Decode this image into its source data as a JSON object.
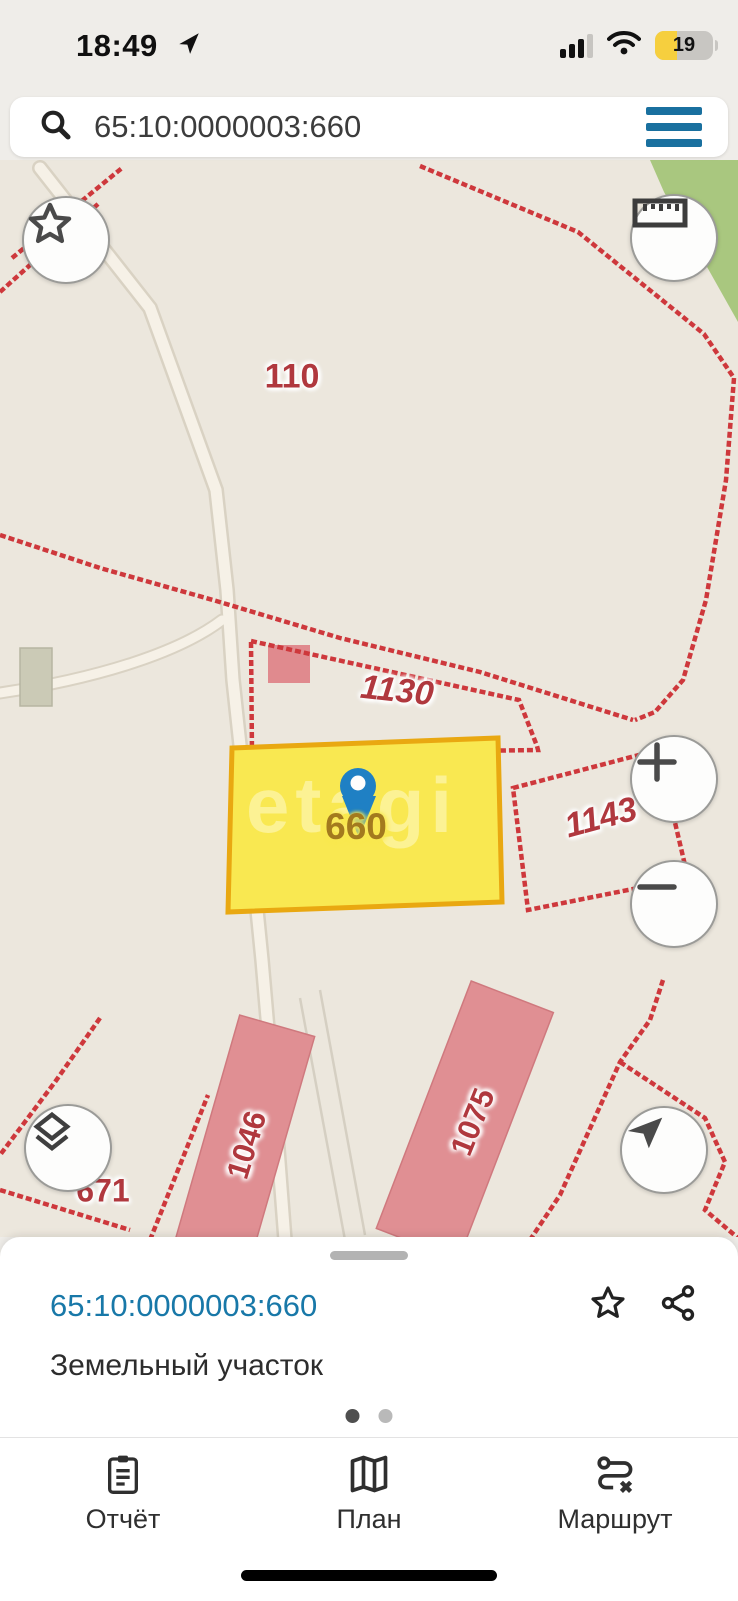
{
  "status_bar": {
    "time": "18:49",
    "battery_percent": "19"
  },
  "search_bar": {
    "query": "65:10:0000003:660"
  },
  "map": {
    "watermark": "etagi",
    "parcel_labels": [
      {
        "text": "110"
      },
      {
        "text": "1130"
      },
      {
        "text": "1143"
      },
      {
        "text": "671"
      }
    ],
    "selected_parcel": {
      "number": "660"
    },
    "building_labels": [
      {
        "text": "1046"
      },
      {
        "text": "1075"
      }
    ]
  },
  "bottom_sheet": {
    "cadastral_number": "65:10:0000003:660",
    "object_type": "Земельный участок"
  },
  "bottom_nav": {
    "items": [
      {
        "label": "Отчёт"
      },
      {
        "label": "План"
      },
      {
        "label": "Маршрут"
      }
    ]
  },
  "colors": {
    "accent_blue": "#19709f",
    "link_blue": "#1878a8",
    "parcel_red": "#ce383c",
    "label_red": "#b0383e",
    "selected_fill": "#f9e851",
    "selected_border": "#e9a811",
    "pin_blue": "#1f80c4",
    "building_pink": "#e08f93",
    "green_area": "#a9c77f",
    "map_bg": "#ece7dd"
  }
}
